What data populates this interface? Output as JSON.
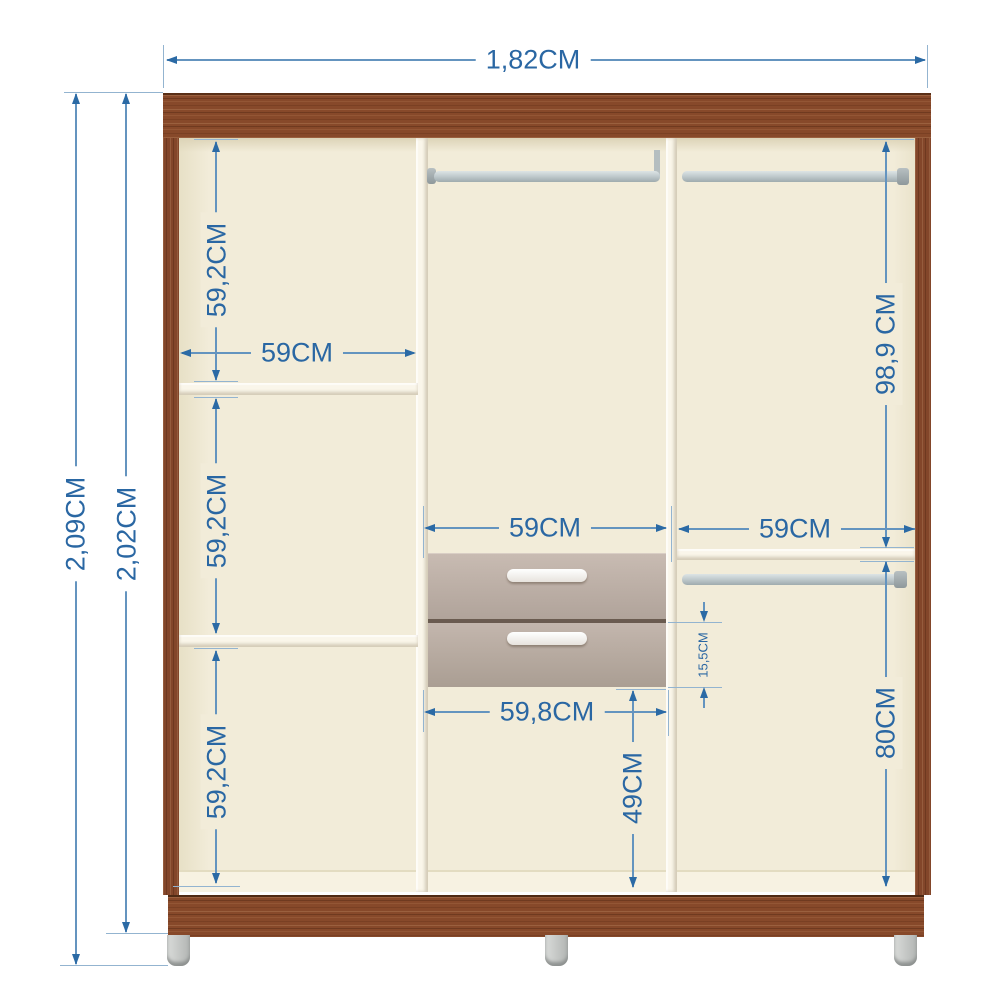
{
  "diagram": {
    "type": "furniture-dimension-diagram",
    "subject": "three-column wardrobe interior with shelves, two drawers and three hanging rails"
  },
  "labels": {
    "total_width": "1,82CM",
    "outer_height": "2,09CM",
    "inner_height": "2,02CM",
    "left_cell_top": "59,2CM",
    "left_cell_mid": "59,2CM",
    "left_cell_bottom": "59,2CM",
    "left_col_width": "59CM",
    "mid_col_width": "59CM",
    "right_col_width": "59CM",
    "right_top_height": "98,9 CM",
    "drawer_front_height": "15,5CM",
    "mid_lower_width": "59,8CM",
    "mid_lower_height": "49CM",
    "right_lower_height": "80CM"
  },
  "colors": {
    "dimension_line": "#6494bf",
    "dimension_arrow": "#2b6aa5",
    "dimension_text": "#2a67a3",
    "wood": "#87492a",
    "interior": "#f2ecd9",
    "panel_white": "#faf6ea",
    "drawer_front": "#b7aaa1",
    "drawer_handle": "#ffffff",
    "rail": "#c2cccf",
    "leg": "#c6c9c7"
  }
}
